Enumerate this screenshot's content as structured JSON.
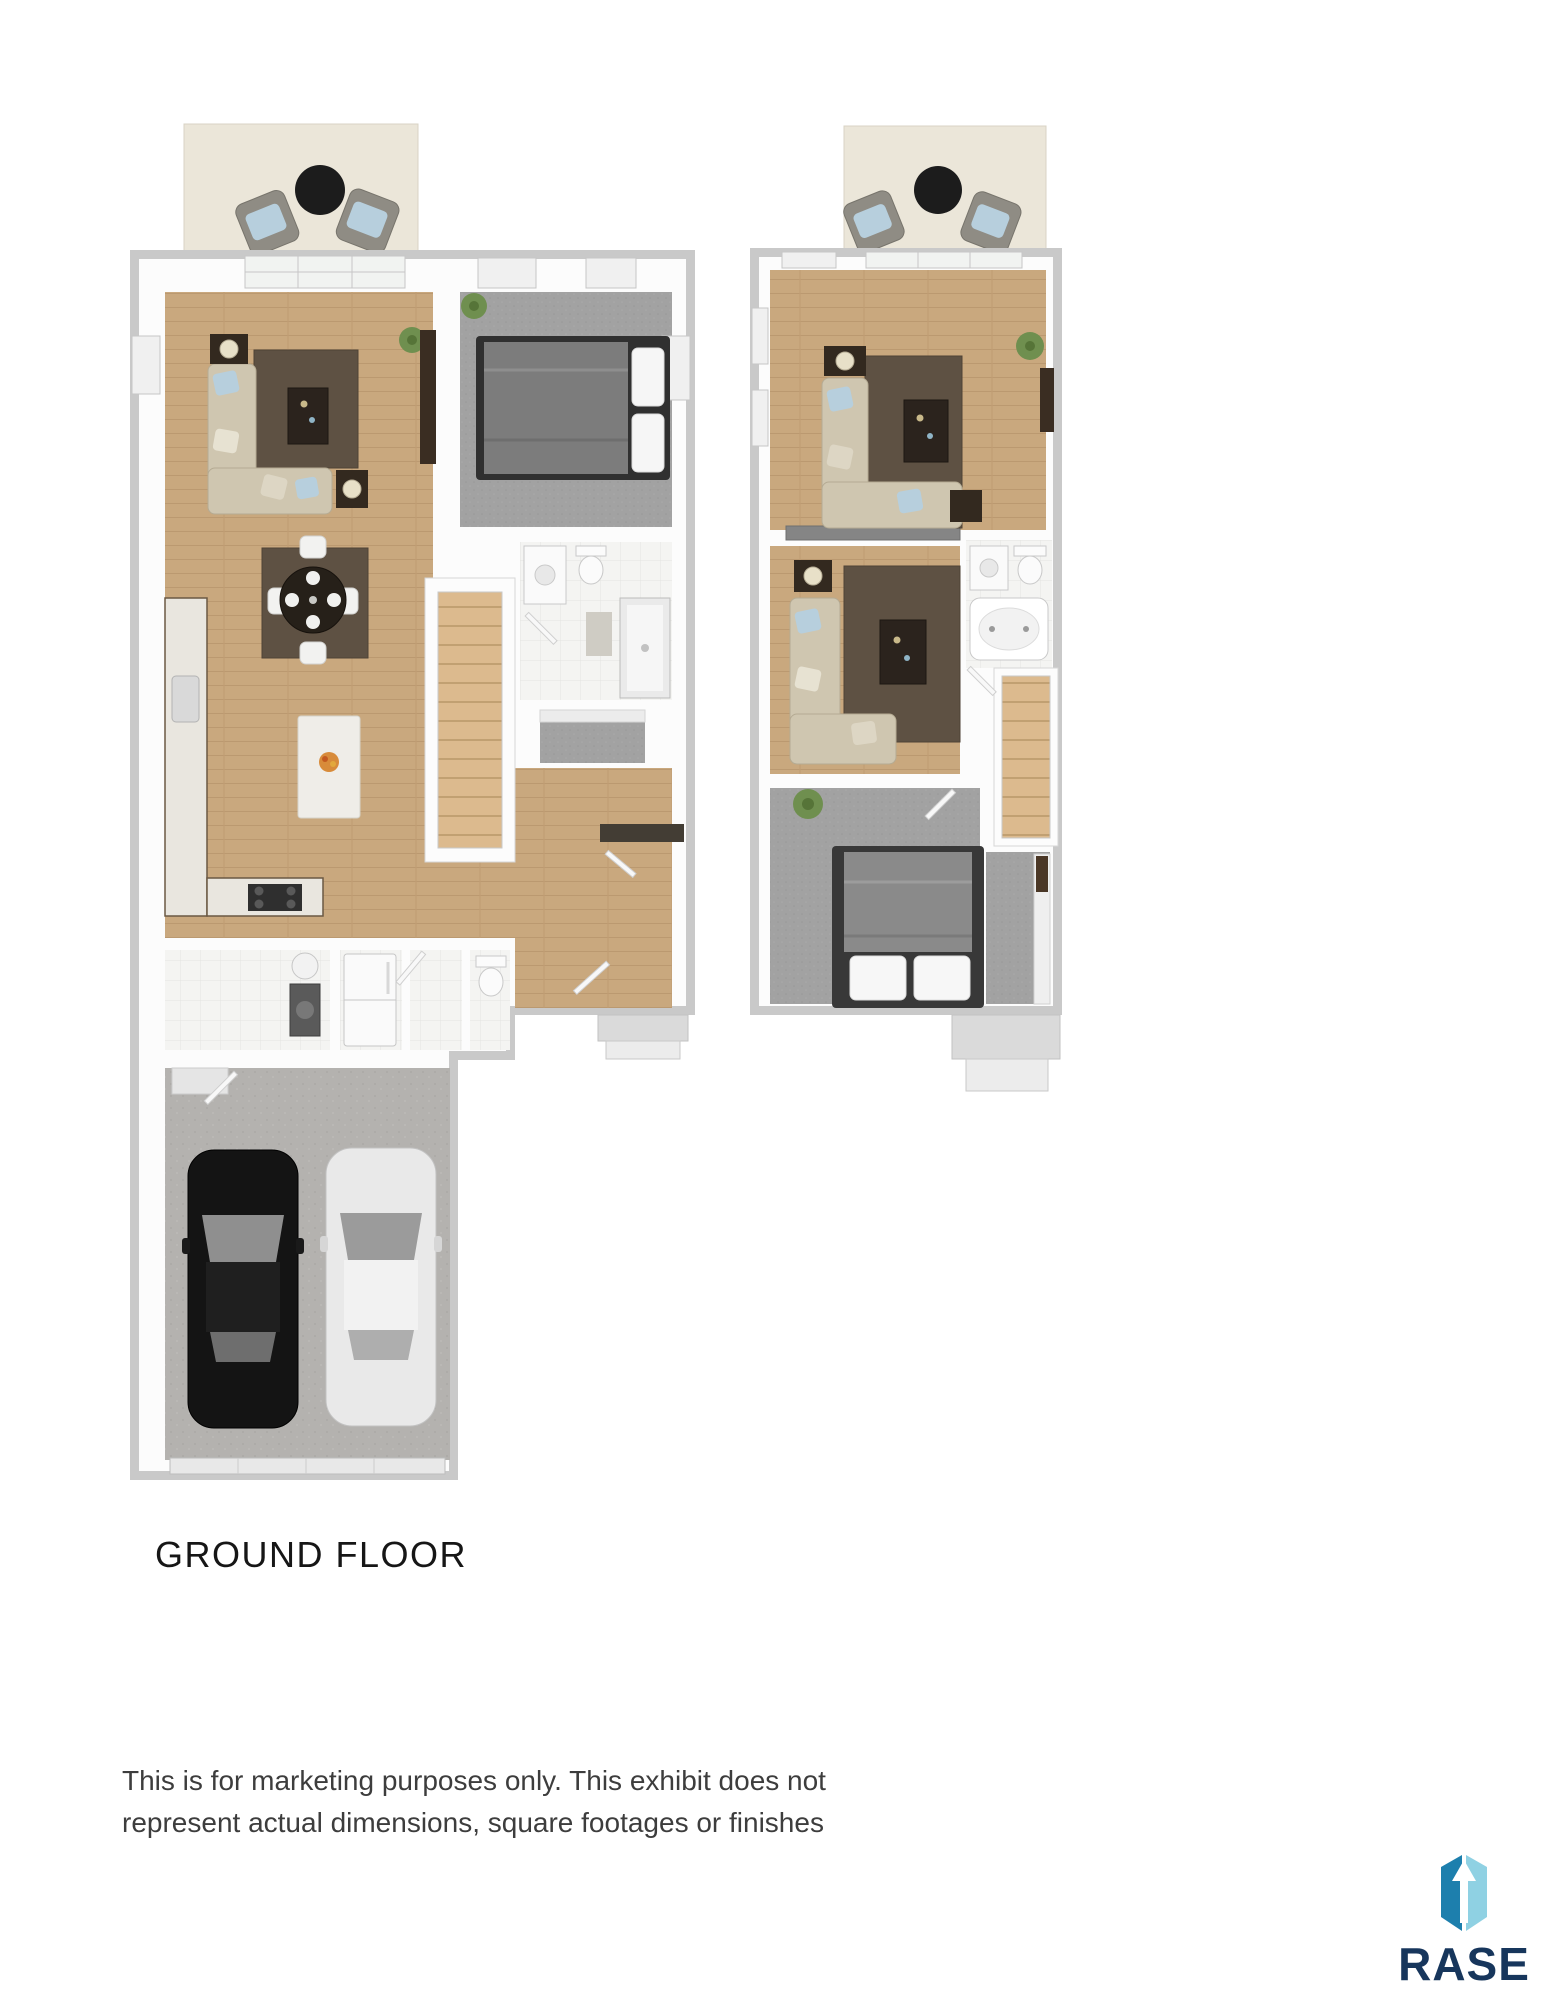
{
  "document": {
    "type": "floor-plan-marketing-sheet",
    "background": "#ffffff"
  },
  "floor_plans": {
    "ground": {
      "label": "GROUND FLOOR",
      "rooms": [
        "patio",
        "living-room",
        "dining-area",
        "kitchen",
        "bedroom",
        "bathroom",
        "closet",
        "entry",
        "stairs",
        "laundry-room",
        "powder-room",
        "two-car-garage"
      ],
      "furniture": [
        "patio-armchairs",
        "patio-round-table",
        "sectional-sofa",
        "coffee-table",
        "side-tables",
        "dining-table-with-4-chairs",
        "kitchen-island",
        "range",
        "refrigerator",
        "washer",
        "water-heater",
        "bed",
        "shower",
        "vanity",
        "toilet",
        "black-car",
        "white-car"
      ]
    },
    "upper": {
      "rooms": [
        "balcony",
        "loft-living-room",
        "family-room",
        "bathroom",
        "stairs",
        "bedroom",
        "hall-closet"
      ],
      "furniture": [
        "balcony-armchairs",
        "balcony-round-table",
        "sectional-sofas",
        "coffee-tables",
        "soaking-tub",
        "vanity",
        "toilet",
        "bed",
        "plants"
      ]
    }
  },
  "disclaimer": {
    "line1": "This is for marketing purposes only. This exhibit does not",
    "line2": "represent actual dimensions, square footages or finishes"
  },
  "logo": {
    "text": "RASE",
    "mark": "rase-box-arrow-icon",
    "colors": {
      "navy": "#17365c",
      "blue_dark": "#1d7fad",
      "blue_light": "#8fd1e3",
      "arrow": "#ffffff"
    }
  },
  "palette": {
    "wall_shadow": "#c9c9c9",
    "wall": "#fcfcfc",
    "wood_floor": "#c9a87e",
    "carpet": "#a2a2a2",
    "tile": "#f4f4f2",
    "rug": "#5e5143",
    "sofa": "#cfc6b0",
    "accent_pillow": "#b7cfdd",
    "concrete": "#b4b2af",
    "stair_tread": "#dcba8e",
    "bed_blanket": "#8a8a8a"
  }
}
